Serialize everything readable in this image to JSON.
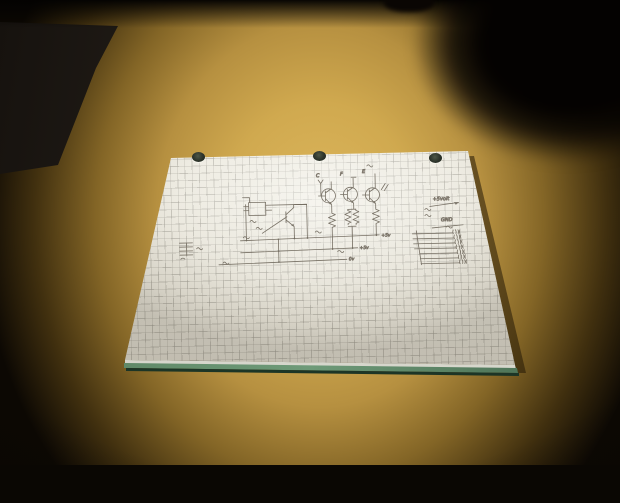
{
  "photo": {
    "colors": {
      "desk_light": "#ddb75d",
      "desk_dark": "#0c0803",
      "paper": "#e9e6db",
      "grid_line": "#969389",
      "pad_edge_green": "#577f5e",
      "ink": "#6e675b"
    },
    "paper": {
      "hole_count": 3
    },
    "schematic": {
      "transistor_labels": [
        "C",
        "F",
        "E"
      ],
      "rail_labels": [
        "+5v",
        "+5v",
        "0v"
      ],
      "header": {
        "power_label": "+5volt",
        "ground_label": "GND",
        "pin_line_count": 7
      }
    }
  }
}
